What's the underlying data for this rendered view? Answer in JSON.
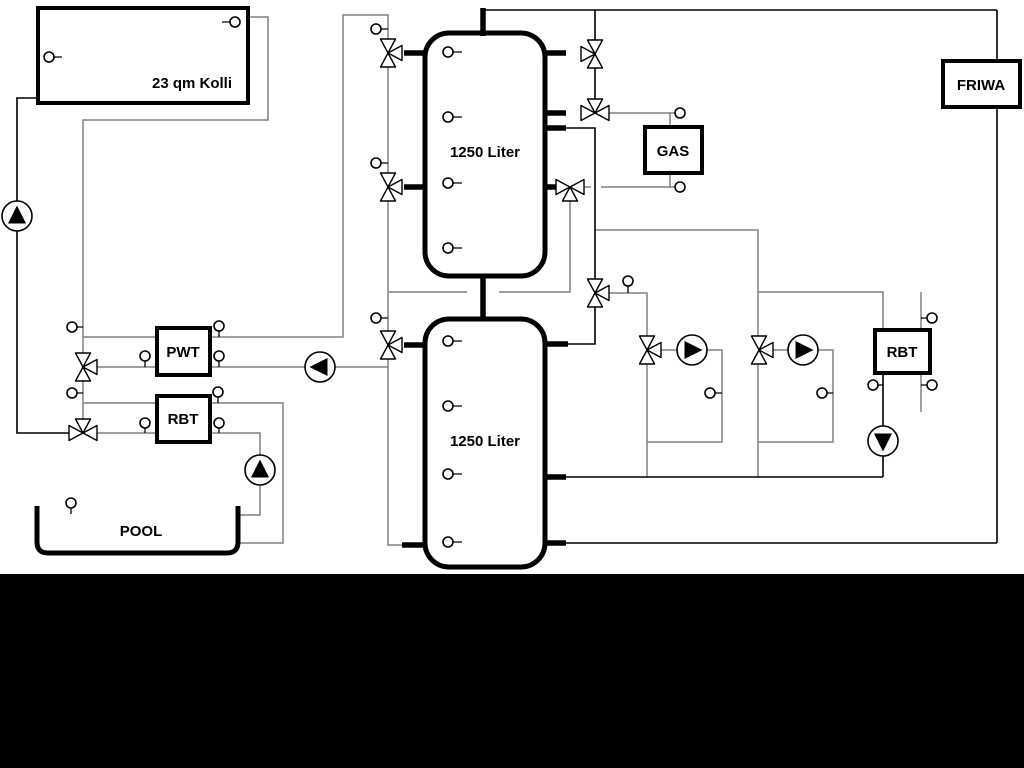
{
  "diagram": {
    "labels": {
      "collector": "23 qm Kolli",
      "tank_upper": "1250 Liter",
      "tank_lower": "1250 Liter",
      "pwt": "PWT",
      "rbt_pool": "RBT",
      "gas": "GAS",
      "friwa": "FRIWA",
      "rbt_right": "RBT",
      "pool": "POOL"
    },
    "colors": {
      "background": "#ffffff",
      "pipe_gray": "#808080",
      "pipe_black": "#000000",
      "footer_band": "#000000"
    }
  }
}
